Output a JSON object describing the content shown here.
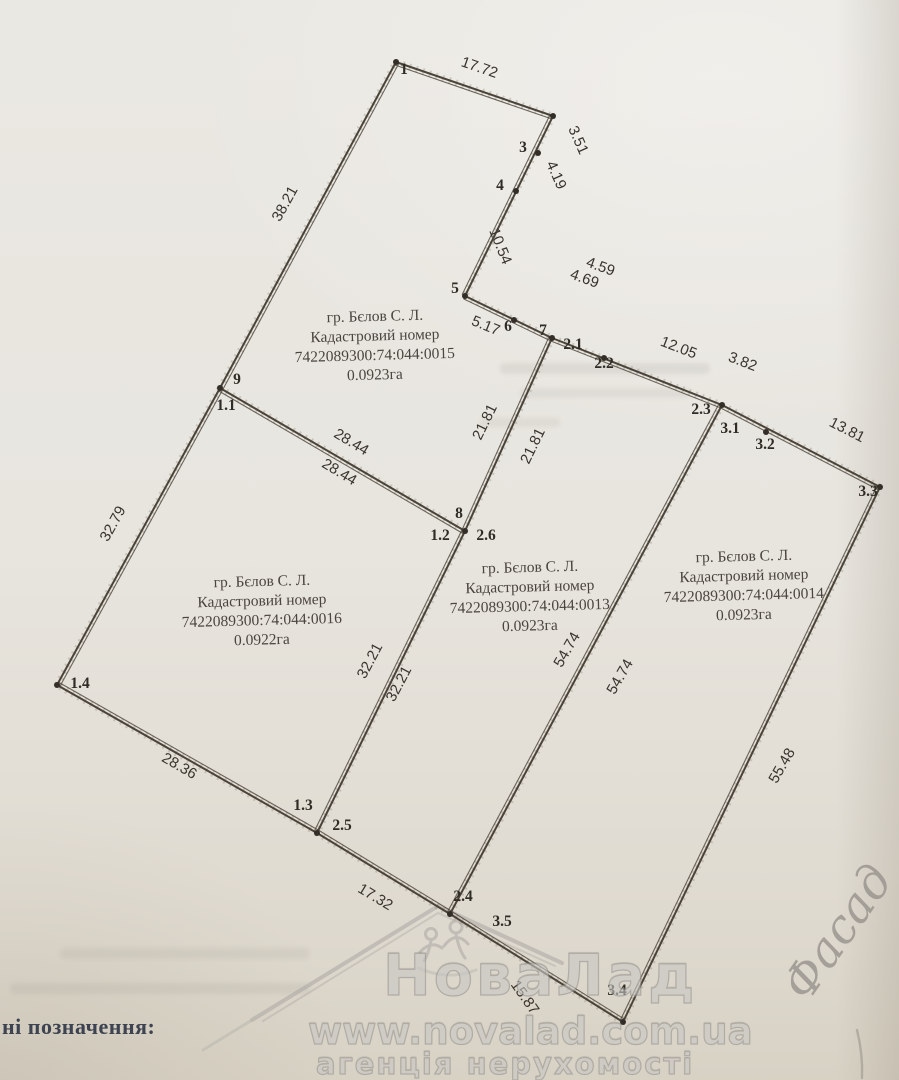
{
  "legend": {
    "text": "ні позначення:"
  },
  "watermark": {
    "brand": "НоваЛад",
    "url": "www.novalad.com.ua",
    "tagline": "агенція нерухомості"
  },
  "handwriting": {
    "text": "Фасад"
  },
  "colors": {
    "paper": "#e8e5df",
    "ink": "#4a4339",
    "fuzz": "#7a6f60",
    "label": "#39342d",
    "parcel_text": "#4a453e"
  },
  "plan": {
    "parcels": [
      {
        "cx": 375,
        "y0": 321,
        "lines": [
          "гр. Бєлов С. Л.",
          "Кадастровий номер",
          "7422089300:74:044:0015",
          "0.0923га"
        ]
      },
      {
        "cx": 262,
        "y0": 586,
        "lines": [
          "гр. Бєлов С. Л.",
          "Кадастровий номер",
          "7422089300:74:044:0016",
          "0.0922га"
        ]
      },
      {
        "cx": 530,
        "y0": 572,
        "lines": [
          "гр. Бєлов С. Л.",
          "Кадастровий номер",
          "7422089300:74:044:0013",
          "0.0923га"
        ]
      },
      {
        "cx": 744,
        "y0": 561,
        "lines": [
          "гр. Бєлов С. Л.",
          "Кадастровий номер",
          "7422089300:74:044:0014",
          "0.0923га"
        ]
      }
    ],
    "edges": [
      [
        396,
        62,
        553,
        116
      ],
      [
        553,
        116,
        465,
        296
      ],
      [
        465,
        296,
        552,
        338
      ],
      [
        552,
        338,
        722,
        405
      ],
      [
        722,
        405,
        880,
        487
      ],
      [
        880,
        487,
        623,
        1022
      ],
      [
        623,
        1022,
        450,
        914
      ],
      [
        450,
        914,
        317,
        833
      ],
      [
        317,
        833,
        57,
        685
      ],
      [
        57,
        685,
        220,
        388
      ],
      [
        220,
        388,
        396,
        62
      ],
      [
        220,
        388,
        465,
        531
      ],
      [
        552,
        338,
        465,
        531
      ],
      [
        465,
        531,
        317,
        833
      ],
      [
        722,
        405,
        450,
        914
      ]
    ],
    "vertex_dots": [
      [
        396,
        62
      ],
      [
        553,
        116
      ],
      [
        538,
        153
      ],
      [
        516,
        191
      ],
      [
        465,
        296
      ],
      [
        514,
        320
      ],
      [
        552,
        338
      ],
      [
        220,
        388
      ],
      [
        465,
        531
      ],
      [
        57,
        685
      ],
      [
        317,
        833
      ],
      [
        722,
        405
      ],
      [
        604,
        358
      ],
      [
        766,
        432
      ],
      [
        880,
        487
      ],
      [
        623,
        1022
      ],
      [
        450,
        914
      ]
    ],
    "point_labels": [
      {
        "t": "1",
        "x": 404,
        "y": 74
      },
      {
        "t": "3",
        "x": 523,
        "y": 152
      },
      {
        "t": "4",
        "x": 500,
        "y": 190
      },
      {
        "t": "5",
        "x": 455,
        "y": 293
      },
      {
        "t": "6",
        "x": 508,
        "y": 331
      },
      {
        "t": "7",
        "x": 543,
        "y": 335
      },
      {
        "t": "9",
        "x": 237,
        "y": 384
      },
      {
        "t": "8",
        "x": 459,
        "y": 518
      },
      {
        "t": "1.1",
        "x": 226,
        "y": 410
      },
      {
        "t": "1.2",
        "x": 440,
        "y": 540
      },
      {
        "t": "2.6",
        "x": 486,
        "y": 540
      },
      {
        "t": "1.3",
        "x": 303,
        "y": 810
      },
      {
        "t": "2.5",
        "x": 342,
        "y": 830
      },
      {
        "t": "1.4",
        "x": 80,
        "y": 688
      },
      {
        "t": "2.1",
        "x": 573,
        "y": 349
      },
      {
        "t": "2.2",
        "x": 604,
        "y": 368
      },
      {
        "t": "2.3",
        "x": 701,
        "y": 414
      },
      {
        "t": "3.1",
        "x": 730,
        "y": 433
      },
      {
        "t": "3.2",
        "x": 765,
        "y": 449
      },
      {
        "t": "3.3",
        "x": 868,
        "y": 496
      },
      {
        "t": "3.4",
        "x": 617,
        "y": 995
      },
      {
        "t": "2.4",
        "x": 463,
        "y": 901
      },
      {
        "t": "3.5",
        "x": 502,
        "y": 926
      }
    ],
    "dims": [
      {
        "t": "17.72",
        "x": 478,
        "y": 72,
        "r": 19
      },
      {
        "t": "3.51",
        "x": 574,
        "y": 142,
        "r": 66
      },
      {
        "t": "4.19",
        "x": 552,
        "y": 177,
        "r": 66
      },
      {
        "t": "10.54",
        "x": 496,
        "y": 248,
        "r": 68
      },
      {
        "t": "4.59",
        "x": 599,
        "y": 271,
        "r": 20
      },
      {
        "t": "4.69",
        "x": 583,
        "y": 283,
        "r": 20
      },
      {
        "t": "5.17",
        "x": 484,
        "y": 330,
        "r": 22
      },
      {
        "t": "12.05",
        "x": 677,
        "y": 352,
        "r": 21
      },
      {
        "t": "3.82",
        "x": 741,
        "y": 366,
        "r": 21
      },
      {
        "t": "13.81",
        "x": 845,
        "y": 434,
        "r": 27
      },
      {
        "t": "55.48",
        "x": 786,
        "y": 768,
        "r": -60
      },
      {
        "t": "15.87",
        "x": 521,
        "y": 1000,
        "r": 55
      },
      {
        "t": "17.32",
        "x": 373,
        "y": 901,
        "r": 31
      },
      {
        "t": "28.36",
        "x": 177,
        "y": 770,
        "r": 30
      },
      {
        "t": "32.79",
        "x": 117,
        "y": 526,
        "r": -61
      },
      {
        "t": "38.21",
        "x": 289,
        "y": 206,
        "r": -61
      },
      {
        "t": "28.44",
        "x": 349,
        "y": 446,
        "r": 31
      },
      {
        "t": "28.44",
        "x": 337,
        "y": 476,
        "r": 31
      },
      {
        "t": "21.81",
        "x": 489,
        "y": 424,
        "r": -64
      },
      {
        "t": "21.81",
        "x": 537,
        "y": 448,
        "r": -64
      },
      {
        "t": "32.21",
        "x": 374,
        "y": 663,
        "r": -62
      },
      {
        "t": "32.21",
        "x": 403,
        "y": 686,
        "r": -62
      },
      {
        "t": "54.74",
        "x": 571,
        "y": 652,
        "r": -60
      },
      {
        "t": "54.74",
        "x": 624,
        "y": 679,
        "r": -60
      }
    ]
  }
}
